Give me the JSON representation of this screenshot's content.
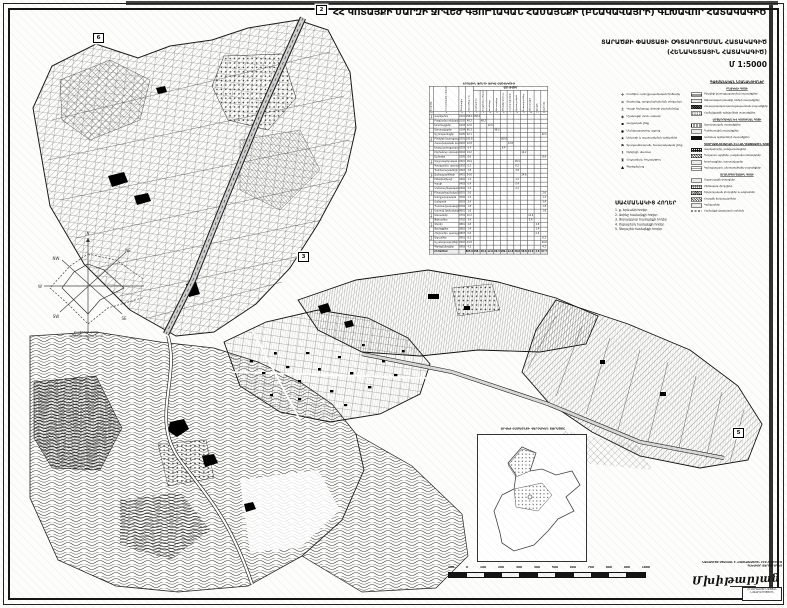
{
  "sheet": {
    "title": {
      "main": "ՀՀ ԿՈՏԱՅՔԻ ՄԱՐԶԻ ՋՐՎԵԺ ԳՅՈՒՂԱԿԱՆ ՀԱՄԱՅՆՔԻ",
      "paren": "(ԲՆԱԿԱՎԱՅՐԻ)",
      "tail": "ԳԼԽԱՎՈՐ ՀԱՏԱԿԱԳԻԾ"
    },
    "subtitle": {
      "line1": "ՏԱՐԱԾՔԻ ՓԱՍՏԱՑԻ ՕԳՏԱԳՈՐԾՄԱՆ ՀԱՏԱԿԱԳԻԾ",
      "line2": "(ՀԵՆԱԿԵՏԱՅԻՆ ՀԱՏԱԿԱԳԻԾ)",
      "scale": "Մ 1:5000"
    }
  },
  "windrose": {
    "dirs": [
      "N",
      "NE",
      "E",
      "SE",
      "S",
      "SW",
      "W",
      "NW"
    ],
    "caption1": "Քամիների վարդ",
    "caption2": "(կրկնելիությունը %-ով)"
  },
  "table": {
    "title": "ՀՈՂԱՅԻՆ ՖՈՆԴԻ ԱՌԿԱ ՀԱՇՎԵԿՇԻՌ",
    "span_header": "ԱՅԴ ԹՎՈՒՄ",
    "headers": [
      "Գոտիներ",
      "Հողատեսքերի անվանումը",
      "Ծածկագիր",
      "Ընդամենը, հա",
      "Վարելահող",
      "Բազմամյա տնկարկ",
      "Խոտհարք",
      "Արոտավայր",
      "Բնակելի կառուց.",
      "Հասարակական",
      "Արտադրական",
      "Ճանապարհներ",
      "Անտառային",
      "Ջրային",
      "Այլ հողեր"
    ],
    "col_numbers": [
      "ա",
      "բ",
      "գ",
      "1",
      "2",
      "3",
      "4",
      "5",
      "6",
      "7",
      "8",
      "9",
      "10",
      "11",
      "12"
    ],
    "rows": [
      [
        "Գյուղատնտեսական",
        "Վարելահող",
        "0101",
        "258.4",
        "258.4",
        "",
        "",
        "",
        "",
        "",
        "",
        "",
        "",
        "",
        ""
      ],
      [
        "",
        "Բազմամյա տնկարկներ",
        "0102",
        "48.2",
        "",
        "48.2",
        "",
        "",
        "",
        "",
        "",
        "",
        "",
        "",
        ""
      ],
      [
        "",
        "Խոտհարքներ",
        "0103",
        "12.6",
        "",
        "",
        "12.6",
        "",
        "",
        "",
        "",
        "",
        "",
        "",
        ""
      ],
      [
        "",
        "Արոտավայրեր",
        "0104",
        "96.3",
        "",
        "",
        "",
        "96.3",
        "",
        "",
        "",
        "",
        "",
        "",
        ""
      ],
      [
        "",
        "Այլ հողատեսքեր",
        "0105",
        "22.1",
        "",
        "",
        "",
        "",
        "",
        "",
        "",
        "",
        "",
        "",
        "22.1"
      ],
      [
        "Բնակավայրերի",
        "Բնակելի կառուցապատման",
        "0201",
        "182.6",
        "",
        "",
        "",
        "",
        "182.6",
        "",
        "",
        "",
        "",
        "",
        ""
      ],
      [
        "",
        "Հասարակական կառուցապատման",
        "0202",
        "12.8",
        "",
        "",
        "",
        "",
        "",
        "12.8",
        "",
        "",
        "",
        "",
        ""
      ],
      [
        "",
        "Խառը կառուցապատման",
        "0203",
        "6.4",
        "",
        "",
        "",
        "",
        "6.4",
        "",
        "",
        "",
        "",
        "",
        ""
      ],
      [
        "",
        "Ընդհանուր օգտագործման",
        "0204",
        "14.2",
        "",
        "",
        "",
        "",
        "",
        "",
        "",
        "14.2",
        "",
        "",
        ""
      ],
      [
        "",
        "Այլ հողեր",
        "0205",
        "8.6",
        "",
        "",
        "",
        "",
        "",
        "",
        "",
        "",
        "",
        "",
        "8.6"
      ],
      [
        "Արդյունաբեր.",
        "Արդյունաբերական օբյեկտների",
        "0301",
        "18.4",
        "",
        "",
        "",
        "",
        "",
        "",
        "18.4",
        "",
        "",
        "",
        ""
      ],
      [
        "",
        "Գյուղատնտ. արտադրական",
        "0302",
        "6.2",
        "",
        "",
        "",
        "",
        "",
        "",
        "6.2",
        "",
        "",
        "",
        ""
      ],
      [
        "",
        "Պահեստարանների",
        "0303",
        "3.8",
        "",
        "",
        "",
        "",
        "",
        "",
        "3.8",
        "",
        "",
        "",
        ""
      ],
      [
        "Տրանսպորտի, կապի",
        "Ճանապարհների",
        "0401",
        "24.6",
        "",
        "",
        "",
        "",
        "",
        "",
        "",
        "24.6",
        "",
        "",
        ""
      ],
      [
        "",
        "Էներգետիկայի",
        "0402",
        "1.2",
        "",
        "",
        "",
        "",
        "",
        "",
        "1.2",
        "",
        "",
        "",
        ""
      ],
      [
        "",
        "Կապի",
        "0403",
        "0.4",
        "",
        "",
        "",
        "",
        "",
        "",
        "0.4",
        "",
        "",
        "",
        ""
      ],
      [
        "",
        "Կոմունալ ենթակառուցվածքների",
        "0404",
        "2.2",
        "",
        "",
        "",
        "",
        "",
        "",
        "2.2",
        "",
        "",
        "",
        ""
      ],
      [
        "Հատուկ պահպանվող",
        "Բնապահպանական",
        "0501",
        "2.6",
        "",
        "",
        "",
        "",
        "",
        "",
        "",
        "",
        "",
        "",
        "2.6"
      ],
      [
        "",
        "Առողջարարական",
        "0502",
        "1.2",
        "",
        "",
        "",
        "",
        "",
        "",
        "",
        "",
        "",
        "",
        "1.2"
      ],
      [
        "",
        "Հանգստի",
        "0503",
        "3.4",
        "",
        "",
        "",
        "",
        "",
        "",
        "",
        "",
        "",
        "",
        "3.4"
      ],
      [
        "",
        "Պատմամշակութային",
        "0504",
        "1.8",
        "",
        "",
        "",
        "",
        "",
        "",
        "",
        "",
        "",
        "",
        "1.8"
      ],
      [
        "Հատուկ նշանակ.",
        "Հատուկ նշանակության",
        "0601",
        "1.6",
        "",
        "",
        "",
        "",
        "",
        "",
        "",
        "",
        "",
        "",
        "1.6"
      ],
      [
        "Անտառային",
        "Անտառներ",
        "0701",
        "12.2",
        "",
        "",
        "",
        "",
        "",
        "",
        "",
        "",
        "12.2",
        "",
        ""
      ],
      [
        "",
        "Թփուտներ",
        "0702",
        "3.4",
        "",
        "",
        "",
        "",
        "",
        "",
        "",
        "",
        "3.4",
        "",
        ""
      ],
      [
        "Ջրային",
        "Գետեր",
        "0801",
        "2.8",
        "",
        "",
        "",
        "",
        "",
        "",
        "",
        "",
        "",
        "2.8",
        ""
      ],
      [
        "",
        "Ջրանցքներ",
        "0802",
        "1.4",
        "",
        "",
        "",
        "",
        "",
        "",
        "",
        "",
        "",
        "1.4",
        ""
      ],
      [
        "",
        "Հիդրոտեխ. կառույցներ",
        "0803",
        "0.6",
        "",
        "",
        "",
        "",
        "",
        "",
        "",
        "",
        "",
        "0.6",
        ""
      ],
      [
        "Պահուստային",
        "Աղուտներ",
        "0901",
        "6.2",
        "",
        "",
        "",
        "",
        "",
        "",
        "",
        "",
        "",
        "",
        "6.2"
      ],
      [
        "",
        "Այլ անօգտագործելի հողեր",
        "0902",
        "44.8",
        "",
        "",
        "",
        "",
        "",
        "",
        "",
        "",
        "",
        "",
        "44.8"
      ],
      [
        "",
        "Գերեզմանոցներ",
        "0903",
        "4.2",
        "",
        "",
        "",
        "",
        "",
        "",
        "",
        "",
        "",
        "",
        "4.2"
      ]
    ],
    "total": [
      "",
      "ԸՆԴԱՄԵՆԸ",
      "",
      "805.0",
      "258.4",
      "48.2",
      "12.6",
      "96.3",
      "189.0",
      "12.8",
      "30.8",
      "38.8",
      "15.6",
      "4.8",
      "97.7"
    ]
  },
  "legend_symbols": {
    "items": [
      {
        "icon": "✛",
        "label": "Բուժկետ, առողջապահական հիմնարկ"
      },
      {
        "icon": "✕",
        "label": "Քարհանք, արդյունահանման տեղամաս"
      },
      {
        "icon": "⚓",
        "label": "Կապի հանգույց, փոստի բաժանմունք"
      },
      {
        "icon": "◈",
        "label": "Մշակույթի տուն, ակումբ"
      },
      {
        "icon": "▪",
        "label": "Վարչական շենք"
      },
      {
        "icon": "◉",
        "label": "Մանկապարտեզ, դպրոց"
      },
      {
        "icon": "★",
        "label": "Առևտրի և սպասարկման օբյեկտներ"
      },
      {
        "icon": "⚑",
        "label": "Գյուղապետարան, հասարակական շենք"
      },
      {
        "icon": "☨",
        "label": "Եկեղեցի, մատուռ"
      },
      {
        "icon": "♜",
        "label": "Հուշարձան, հուշակոթող"
      },
      {
        "icon": "▲",
        "label": "Գերեզմանոց"
      }
    ]
  },
  "legend_swatches": {
    "header": "ՊԱՅՄԱՆԱԿԱՆ ՆՇԱՆԱԿՈՒՄՆԵՐ",
    "sections": [
      {
        "header": "ԲՆԱԿԵԼԻ ԳՈՏԻ",
        "items": [
          {
            "sw": "sw-hlines",
            "label": "Բնակելի կառուցապատման տարածքներ"
          },
          {
            "sw": "sw-lt",
            "label": "Անհատական բնակելի տների տարածքներ"
          },
          {
            "sw": "sw-dark",
            "label": "Հասարակական կառուցապատման տարածքներ"
          },
          {
            "sw": "sw-dots",
            "label": "Համայնքային օբյեկտների տարածքներ"
          }
        ]
      },
      {
        "header": "ԱՐՏԱԴՐԱԿԱՆ ԵՎ ԿՈՄՈՒՆԱԼ ԳՈՏԻ",
        "items": [
          {
            "sw": "sw-vlines",
            "label": "Արտադրական տարածքներ"
          },
          {
            "sw": "sw-lt",
            "label": "Պահեստային տարածքներ"
          },
          {
            "sw": "sw-black",
            "label": "Կոմունալ օբյեկտների տարածքներ"
          }
        ]
      },
      {
        "header": "ԳՅՈՒՂԱՏՆՏԵՍԱԿԱՆ ԵՎ ԼԱՆԴՇԱՖՏԱՅԻՆ ԳՈՏԻ",
        "items": [
          {
            "sw": "sw-blackd",
            "label": "Վարելահողեր, բանջարանոցներ"
          },
          {
            "sw": "sw-diag",
            "label": "Պտղատու այգիներ, բազմամյա տնկարկներ"
          },
          {
            "sw": "sw-lt",
            "label": "Խոտհարքներ, արոտավայրեր"
          },
          {
            "sw": "sw-wave",
            "label": "Կանաչապատ, անտառածածկ տարածքներ"
          }
        ]
      },
      {
        "header": "ՏՐԱՆՍՊՈՐՏԱՅԻՆ ԳՈՏԻ",
        "items": [
          {
            "sw": "sw-lt",
            "label": "Մայրուղային փողոցներ"
          },
          {
            "sw": "sw-grid",
            "label": "Հիմնական փողոցներ"
          },
          {
            "sw": "sw-cross",
            "label": "Երկրորդական փողոցներ և անցումներ"
          },
          {
            "sw": "sw-diag",
            "label": "Հողային ճանապարհներ"
          },
          {
            "sw": "sw-lt",
            "label": "Կանգառներ"
          },
          {
            "sw": "sw-dash",
            "label": "Համայնքի վարչական սահման"
          }
        ]
      }
    ]
  },
  "adjacent_lands": {
    "header": "ՍԱՀՄԱՆԱԿԻՑ ՀՈՂԵՐ",
    "items": [
      "1. ք. Երևանի հողեր",
      "2. Առինջ համայնքի հողեր",
      "3. Ձորաղբյուր համայնքի հողեր",
      "4. Ողջաբերդ համայնքի հողեր",
      "5. Գեղաշեն համայնքի հողեր"
    ]
  },
  "inset": {
    "title": "ՋՐՎԵԺ ՀԱՄԱՅՆՔԻ ՎԱՐՉԱԿԱՆ ՏԱՐԱԾՔԸ"
  },
  "scalebar": {
    "ticks": [
      "100",
      "0",
      "100",
      "200",
      "300",
      "400",
      "500",
      "600",
      "700",
      "800",
      "900",
      "1000"
    ]
  },
  "credits": {
    "line1": "ՆԱԽԱԳԻԾԸ ՄՇԱԿՎԵԼ Է «ՀԱՅՆԱԽԱԳԻԾ» ԲԲԸ-Ի ԿՈՂՄԻՑ",
    "line2": "ԳԼԽԱՎՈՐ ՃԱՐՏԱՐԱՊԵՏ",
    "signature": "Մխիթարյան",
    "stamp1": "ՀՀ ՔԱՂԱՔԱՇԻՆՈՒԹՅԱՆ",
    "stamp2": "ՆԱԽԱՐԱՐՈՒԹՅՈՒՆ"
  },
  "map": {
    "markers": [
      {
        "n": "2",
        "x": 316,
        "y": 5
      },
      {
        "n": "6",
        "x": 93,
        "y": 33
      },
      {
        "n": "3",
        "x": 298,
        "y": 252
      },
      {
        "n": "5",
        "x": 733,
        "y": 428
      }
    ]
  }
}
